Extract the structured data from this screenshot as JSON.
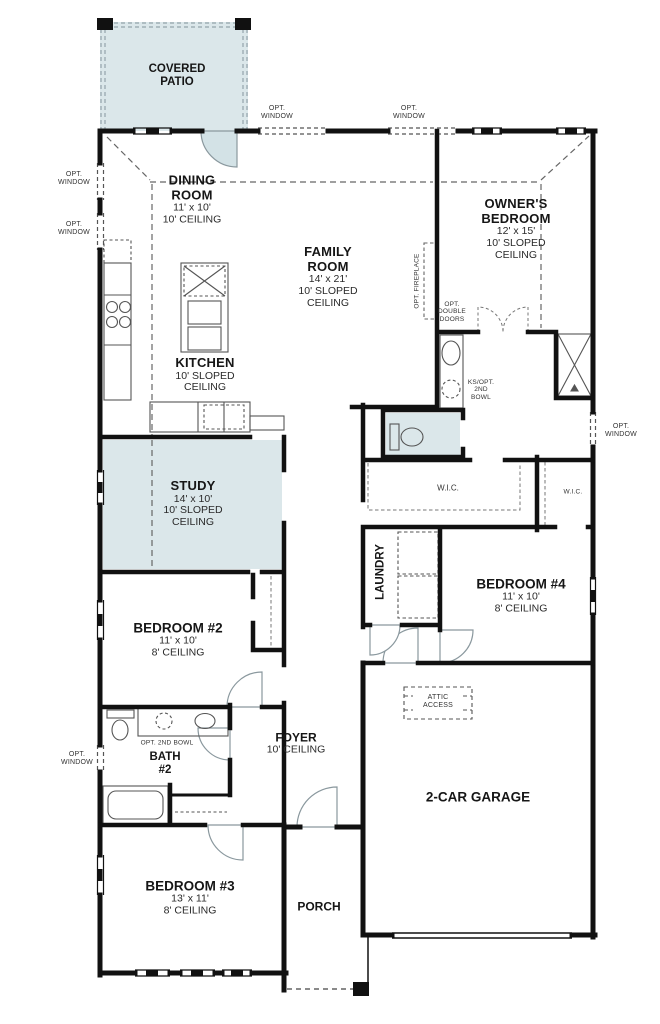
{
  "plan": {
    "rooms": {
      "covered_patio": {
        "name": "COVERED PATIO"
      },
      "dining": {
        "name": "DINING ROOM",
        "dims": "11' x 10'",
        "ceiling": "10' CEILING"
      },
      "family": {
        "name": "FAMILY ROOM",
        "dims": "14' x 21'",
        "ceiling": "10' SLOPED CEILING"
      },
      "owners": {
        "name": "OWNER'S BEDROOM",
        "dims": "12' x 15'",
        "ceiling": "10' SLOPED CEILING"
      },
      "kitchen": {
        "name": "KITCHEN",
        "ceiling": "10' SLOPED CEILING"
      },
      "study": {
        "name": "STUDY",
        "dims": "14' x 10'",
        "ceiling": "10' SLOPED CEILING"
      },
      "bedroom2": {
        "name": "BEDROOM #2",
        "dims": "11' x 10'",
        "ceiling": "8' CEILING"
      },
      "bedroom3": {
        "name": "BEDROOM #3",
        "dims": "13' x 11'",
        "ceiling": "8' CEILING"
      },
      "bedroom4": {
        "name": "BEDROOM #4",
        "dims": "11' x 10'",
        "ceiling": "8' CEILING"
      },
      "bath2": {
        "name": "BATH #2"
      },
      "laundry": {
        "name": "LAUNDRY"
      },
      "foyer": {
        "name": "FOYER",
        "ceiling": "10' CEILING"
      },
      "porch": {
        "name": "PORCH"
      },
      "garage": {
        "name": "2-CAR GARAGE"
      },
      "wic1": {
        "name": "W.I.C."
      },
      "wic2": {
        "name": "W.I.C."
      }
    },
    "annotations": {
      "opt_window": "OPT. WINDOW",
      "opt_fireplace": "OPT. FIREPLACE",
      "opt_double_doors": "OPT. DOUBLE DOORS",
      "ks_opt_2nd_bowl": "KS/OPT. 2ND BOWL",
      "opt_2nd_bowl": "OPT. 2ND BOWL",
      "attic_access": "ATTIC ACCESS"
    },
    "colors": {
      "wall": "#111111",
      "shaded_room": "#dbe7ea",
      "dashed": "#666666",
      "background": "#ffffff"
    }
  }
}
